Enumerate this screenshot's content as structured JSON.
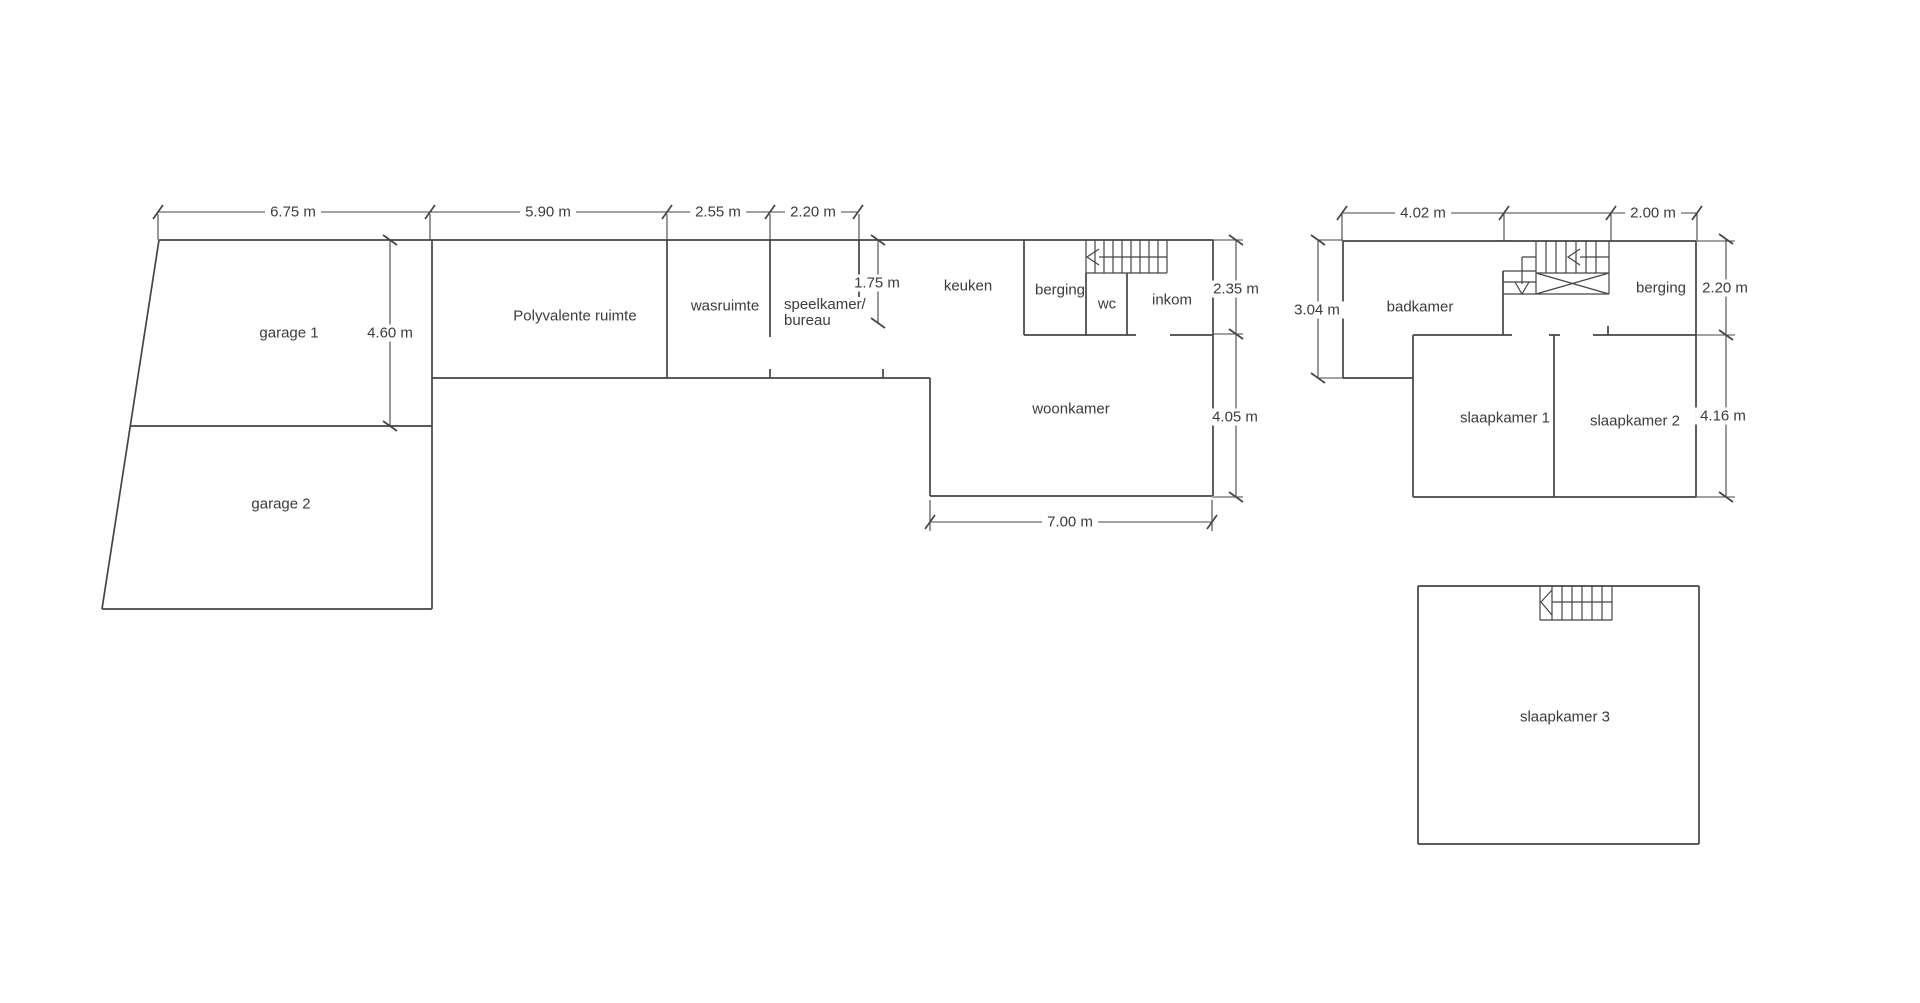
{
  "colors": {
    "line-color": "#454545",
    "text-color": "#3c3c3c",
    "bg-color": "#ffffff"
  },
  "ground_floor": {
    "rooms": {
      "garage_1": "garage 1",
      "garage_2": "garage 2",
      "polyvalente_ruimte": "Polyvalente ruimte",
      "wasruimte": "wasruimte",
      "speelkamer_line_1": "speelkamer/",
      "speelkamer_line_2": "bureau",
      "keuken": "keuken",
      "berging": "berging",
      "wc": "wc",
      "inkom": "inkom",
      "woonkamer": "woonkamer"
    },
    "dimensions": {
      "garage_width": "6.75 m",
      "garage_depth": "4.60 m",
      "polyvalente_width": "5.90 m",
      "wasruimte_width": "2.55 m",
      "speelkamer_width": "2.20 m",
      "speelkamer_depth": "1.75 m",
      "inkom_depth": "2.35 m",
      "woonkamer_depth": "4.05 m",
      "woonkamer_width": "7.00 m"
    }
  },
  "first_floor": {
    "rooms": {
      "badkamer": "badkamer",
      "berging": "berging",
      "slaapkamer_1": "slaapkamer 1",
      "slaapkamer_2": "slaapkamer 2"
    },
    "dimensions": {
      "badkamer_width": "4.02 m",
      "berging_width": "2.00 m",
      "badkamer_depth": "3.04 m",
      "berging_depth": "2.20 m",
      "slaapkamer_depth": "4.16 m"
    }
  },
  "second_floor": {
    "rooms": {
      "slaapkamer_3": "slaapkamer 3"
    }
  }
}
